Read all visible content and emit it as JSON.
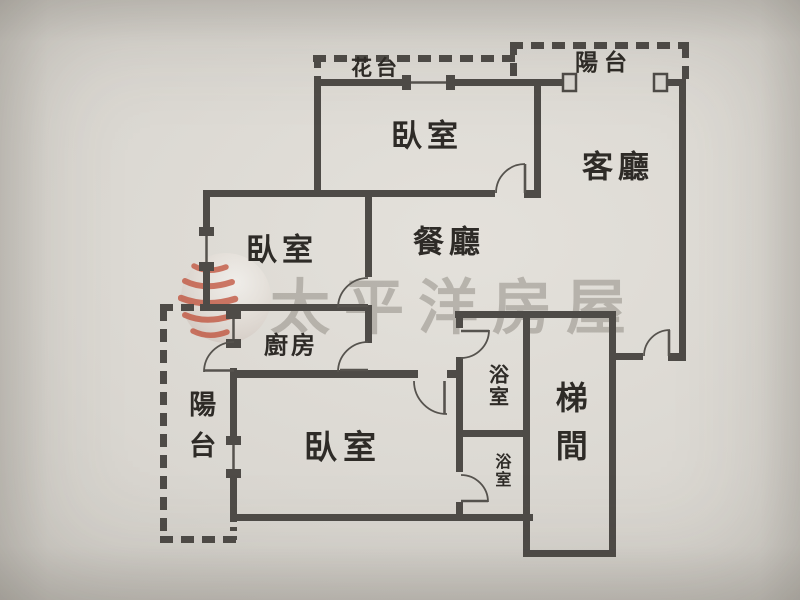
{
  "watermark": {
    "brand": "太平洋房屋"
  },
  "rooms": {
    "flower_terrace": {
      "label": "花台"
    },
    "balcony_upper": {
      "label": "陽台"
    },
    "bedroom_top": {
      "label": "臥室"
    },
    "living_room": {
      "label": "客廳"
    },
    "bedroom_mid": {
      "label": "臥室"
    },
    "dining_room": {
      "label": "餐廳"
    },
    "kitchen": {
      "label": "廚房"
    },
    "balcony_lower": {
      "label": "陽台"
    },
    "bedroom_master": {
      "label": "臥室"
    },
    "bathroom_upper": {
      "label": "浴室"
    },
    "bathroom_lower": {
      "label": "浴室"
    },
    "stairwell": {
      "label": "梯間"
    }
  },
  "colors": {
    "wall": "#4e4b47",
    "line": "#56534e",
    "paper": "#d9d6d0",
    "label": "#2e2b27",
    "wm-gray": "#7d786f",
    "logo-red": "#bf4a33"
  }
}
